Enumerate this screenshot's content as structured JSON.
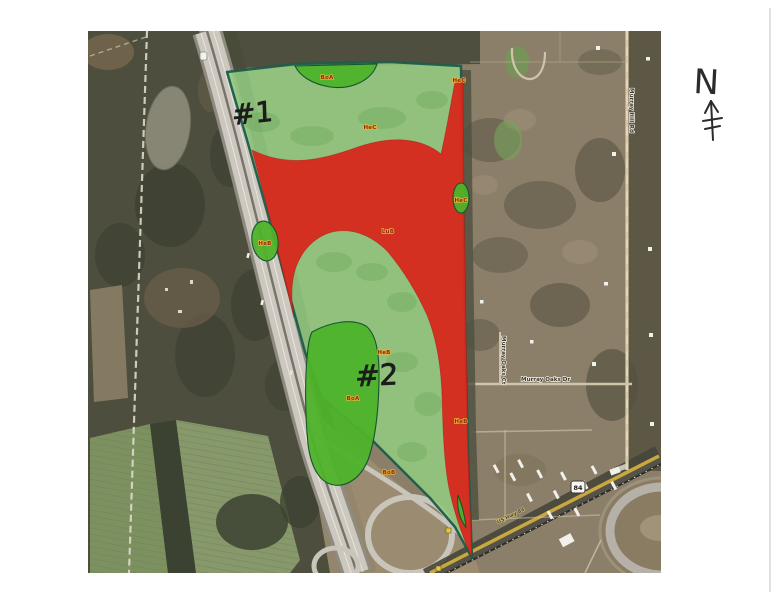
{
  "map": {
    "description": "Scanned aerial photo parcel map with red and green soil-suitability overlay",
    "compass_label": "N",
    "parcel_labels": [
      "#1",
      "#2"
    ],
    "soil_codes": [
      "BoA",
      "HeC",
      "HeC",
      "HeB",
      "LuB",
      "HeC",
      "HeB",
      "BoA",
      "BoB",
      "HeB"
    ],
    "roads": {
      "murray_oaks_dr": "Murray Oaks Dr",
      "murray_oaks_ct": "Murray Oaks Ct",
      "murray_hill_rd": "Murray Hill Rd",
      "us_hwy": "US Hwy 84",
      "shield_number": "84"
    },
    "colors": {
      "overlay_red": "#d8281e",
      "overlay_light_green": "#93c97f",
      "overlay_bright_green": "#4eb32a",
      "parcel_boundary": "#1d5c4b",
      "soil_label_text": "#8a2a06",
      "soil_label_halo": "#edb23c",
      "annotation_ink": "#1c1c1c"
    }
  }
}
